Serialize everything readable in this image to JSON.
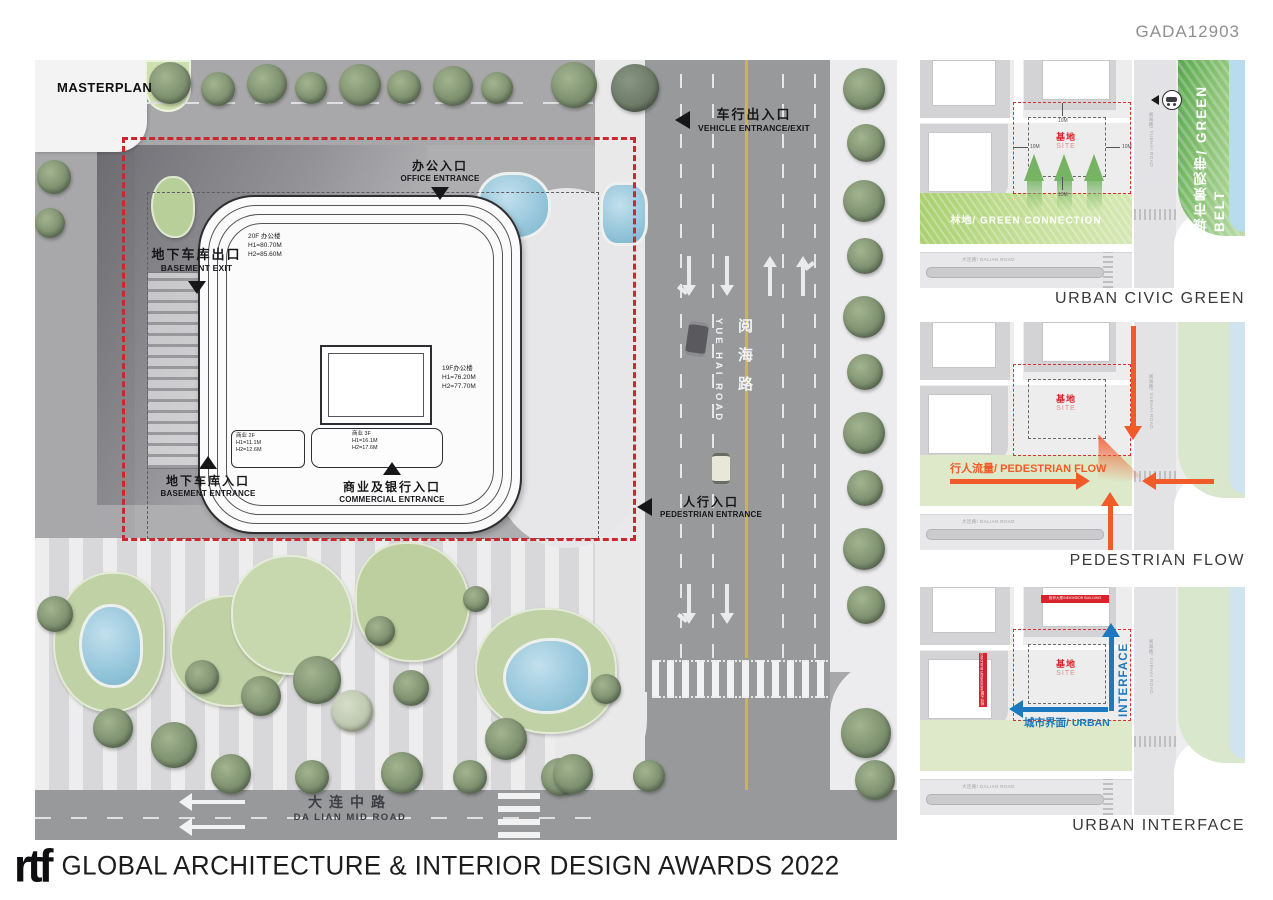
{
  "header": {
    "code": "GADA12903"
  },
  "masterplan": {
    "title": "MASTERPLAN",
    "entrances": {
      "vehicle": {
        "zh": "车行出入口",
        "en": "VEHICLE ENTRANCE/EXIT"
      },
      "office": {
        "zh": "办公入口",
        "en": "OFFICE ENTRANCE"
      },
      "basement_exit": {
        "zh": "地下车库出口",
        "en": "BASEMENT EXIT"
      },
      "basement_entrance": {
        "zh": "地下车库入口",
        "en": "BASEMENT ENTRANCE"
      },
      "commercial": {
        "zh": "商业及银行入口",
        "en": "COMMERCIAL ENTRANCE"
      },
      "pedestrian": {
        "zh": "人行入口",
        "en": "PEDESTRIAN ENTRANCE"
      }
    },
    "buildings": {
      "tower20f": [
        "20F 办公楼",
        "H1=80.70M",
        "H2=85.60M"
      ],
      "tower19f": [
        "19F办公楼",
        "H1=76.20M",
        "H2=77.70M"
      ],
      "podium2f": [
        "商业 2F",
        "H1=11.1M",
        "H2=12.6M"
      ],
      "podium3f": [
        "商业 3F",
        "H1=16.1M",
        "H2=17.6M"
      ]
    },
    "roads": {
      "yuehai_zh": "阅海路",
      "yuehai_en": "YUE HAI ROAD",
      "dalian_zh": "大连中路",
      "dalian_en": "DA LIAN  MID ROAD"
    }
  },
  "panels": [
    {
      "caption": "URBAN CIVIC GREEN",
      "site_zh": "基地",
      "site_en": "SITE",
      "green_connection": "林地/ GREEN CONNECTION",
      "green_belt": "城市景观带/ GREEN BELT",
      "road_v": "阅海路/ YUEHAI ROAD",
      "road_h": "大连路/ DALIAN ROAD",
      "dim": "10M"
    },
    {
      "caption": "PEDESTRIAN FLOW",
      "site_zh": "基地",
      "site_en": "SITE",
      "flow": "行人流量/ PEDESTRIAN FLOW",
      "road_v": "阅海路/ YUEHAI ROAD",
      "road_h": "大连路/ DALIAN ROAD"
    },
    {
      "caption": "URBAN INTERFACE",
      "site_zh": "基地",
      "site_en": "SITE",
      "interface_h": "城市界面/ URBAN",
      "interface_v": "INTERFACE",
      "neighbor": "相邻大厦/NEIGHBOR BUILDING",
      "road_v": "阅海路/ YUEHAI ROAD",
      "road_h": "大连路/ DALIAN ROAD"
    }
  ],
  "footer": {
    "logo": "rtf",
    "title": "GLOBAL ARCHITECTURE & INTERIOR DESIGN AWARDS 2022"
  },
  "colors": {
    "boundary_red": "#c9292e",
    "flow_orange": "#f15a29",
    "interface_blue": "#1c78bf",
    "site_red": "#d8252b"
  }
}
